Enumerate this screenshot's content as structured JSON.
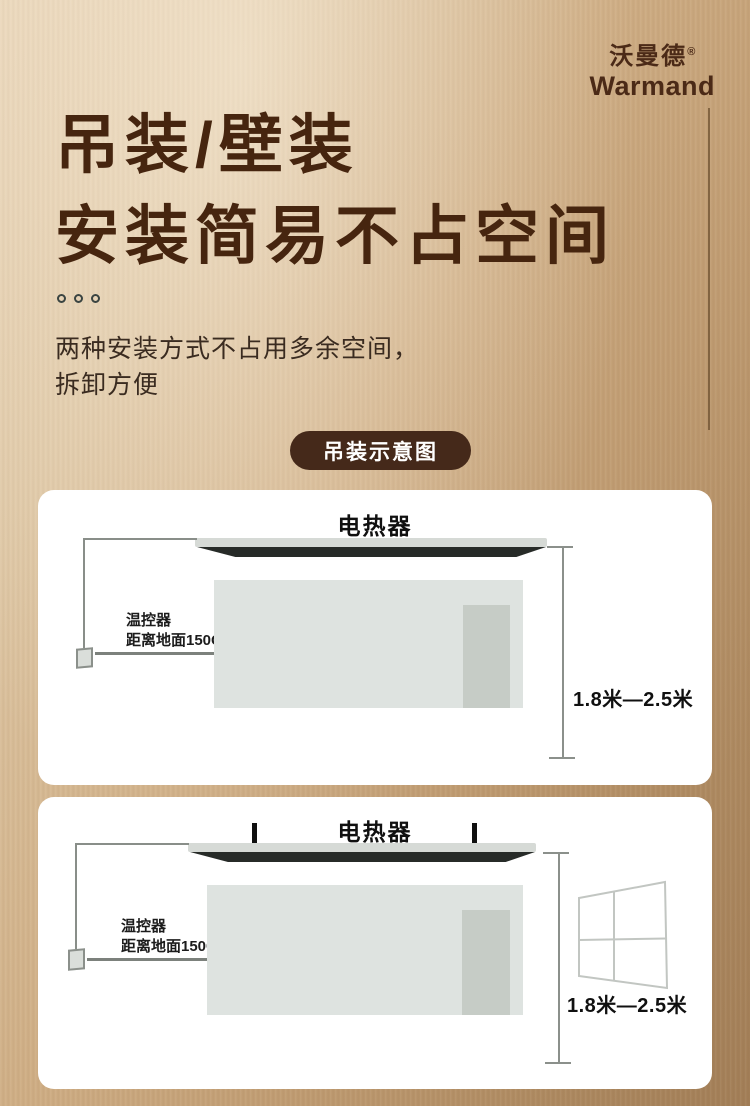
{
  "brand": {
    "name_cn": "沃曼德",
    "reg_mark": "®",
    "name_en": "Warmand"
  },
  "hero": {
    "title_line1": "吊装/壁装",
    "title_line2": "安装简易不占空间",
    "subtitle_line1": "两种安装方式不占用多余空间，",
    "subtitle_line2": "拆卸方便"
  },
  "section_badge": {
    "label": "吊装示意图"
  },
  "diagrams": [
    {
      "name": "ceiling-mount",
      "heater_label": "电热器",
      "thermostat_label": "温控器",
      "thermostat_note": "距离地面150CM",
      "height_range": "1.8米—2.5米"
    },
    {
      "name": "wall-mount",
      "heater_label": "电热器",
      "thermostat_label": "温控器",
      "thermostat_note": "距离地面150CM",
      "height_range": "1.8米—2.5米"
    }
  ],
  "colors": {
    "accent_brown": "#45291a",
    "title_brown": "#46250f",
    "background_bronze": "#c09c72",
    "card_background": "#ffffff",
    "diagram_line_gray": "#8b908b",
    "room_gray": "#dee3e0",
    "heater_dark": "#272b28"
  }
}
